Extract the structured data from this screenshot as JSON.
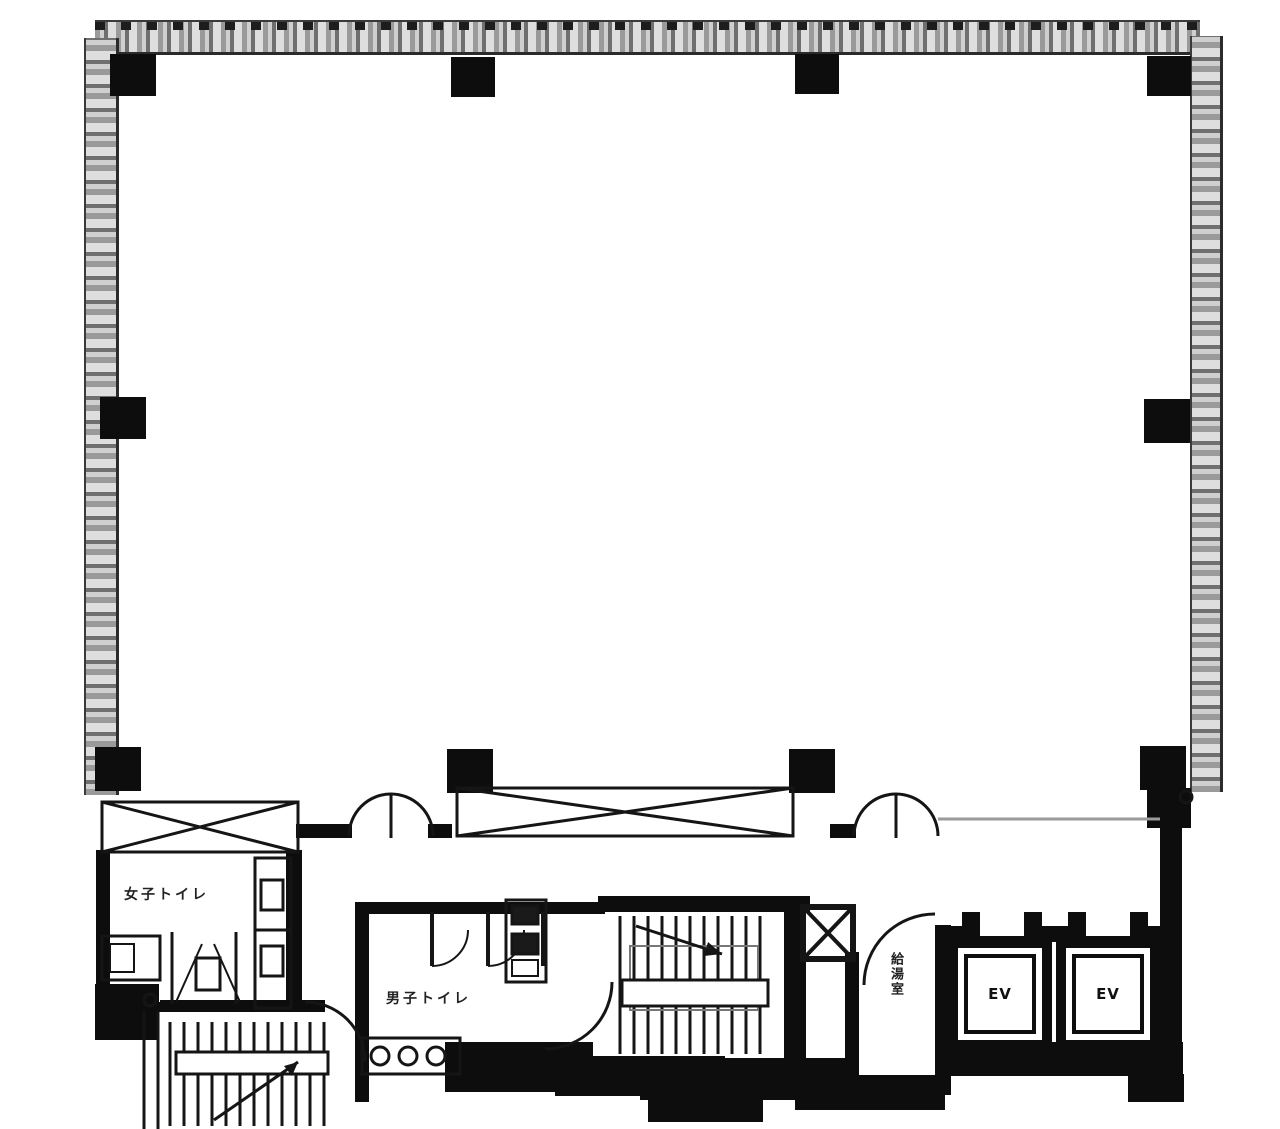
{
  "plan": {
    "type": "building-floor-plan",
    "rooms": {
      "womens_toilet": {
        "label": "女子トイレ"
      },
      "mens_toilet": {
        "label": "男子トイレ"
      },
      "kitchenette": {
        "label": "給湯室"
      },
      "elevator_1": {
        "label": "EV"
      },
      "elevator_2": {
        "label": "EV"
      }
    },
    "colors": {
      "wall": "#0d0d0d",
      "line": "#151515",
      "hatch_dark": "#6f6f6f",
      "hatch_light": "#cfcfcf",
      "faint_line": "#9a9a9a",
      "background": "#ffffff"
    }
  }
}
